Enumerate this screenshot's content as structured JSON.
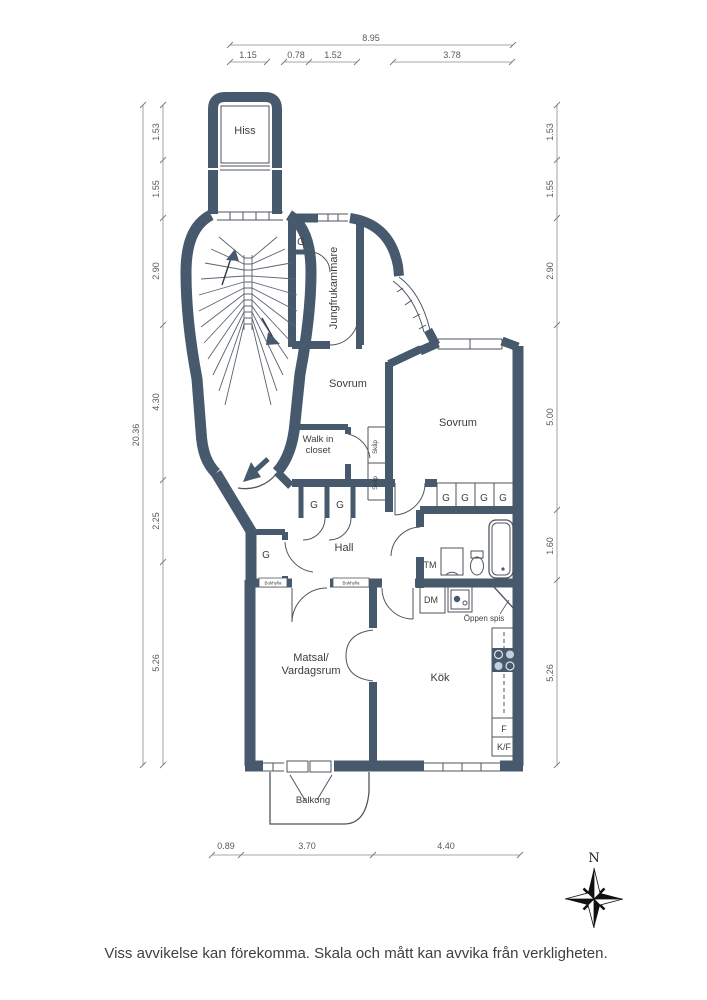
{
  "rooms": {
    "hiss": "Hiss",
    "jungfrukammare": "Jungfrukammare",
    "sovrum1": "Sovrum",
    "sovrum2": "Sovrum",
    "walk_in_1": "Walk in",
    "walk_in_2": "closet",
    "hall": "Hall",
    "matsal_1": "Matsal/",
    "matsal_2": "Vardagsrum",
    "kok": "Kök",
    "balkong": "Balkong"
  },
  "fixtures": {
    "g": "G",
    "skap": "Skåp",
    "tm": "TM",
    "dm": "DM",
    "oppen_spis": "Öppen spis",
    "f": "F",
    "kf": "K/F",
    "bokhylla": "Bokhylla"
  },
  "compass": {
    "north": "N"
  },
  "dimensions": {
    "top_total": "8.95",
    "top": [
      "1.15",
      "0.78",
      "1.52",
      "3.78"
    ],
    "left_total": "20.36",
    "left": [
      "1.53",
      "1.55",
      "2.90",
      "4.30",
      "2.25",
      "5.26"
    ],
    "right": [
      "1.53",
      "1.55",
      "2.90",
      "5.00",
      "1.60",
      "5.26"
    ],
    "bottom": [
      "0.89",
      "3.70",
      "4.40"
    ]
  },
  "footer": {
    "disclaimer": "Viss avvikelse kan förekomma. Skala och mått kan avvika från verkligheten."
  },
  "colors": {
    "wall": "#47596D",
    "line": "#4E565E",
    "text": "#3C3C3C"
  }
}
